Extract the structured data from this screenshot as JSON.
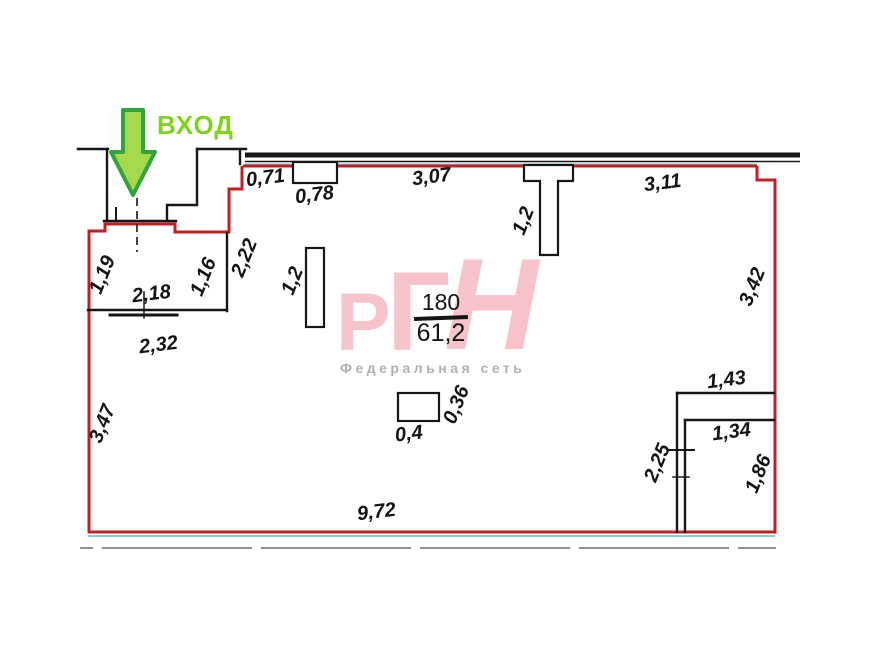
{
  "plan": {
    "entrance_label": "ВХОД",
    "room_number": "180",
    "room_area": "61,2",
    "dimensions": {
      "top_seg1": "0,71",
      "top_pier_w": "0,78",
      "top_seg2": "3,07",
      "top_seg3": "3,11",
      "column_w": "1,2",
      "right_wall": "3,42",
      "storage_top": "1,43",
      "storage_inner_top": "1,34",
      "storage_left": "2,25",
      "storage_right": "1,86",
      "bottom_wall": "9,72",
      "left_wall": "3,47",
      "vestibule_left": "1,19",
      "vestibule_right": "1,16",
      "vestibule_top_w": "2,18",
      "vestibule_bottom_w": "2,32",
      "vestibule_side": "2,22",
      "counter_len": "1,2",
      "box_w": "0,4",
      "box_h": "0,36"
    }
  },
  "watermark": {
    "logo_letters": [
      "Р",
      "Г",
      "Н"
    ],
    "subtitle": "Федеральная сеть"
  },
  "colors": {
    "outline_red": "#C41E25",
    "wall_black": "#161616",
    "glass_cyan": "#7FD2D0",
    "arrow_fill": "#A6D84B",
    "arrow_outline": "#2FA53C",
    "entrance_text_green": "#7FD31A",
    "watermark_pink": "#F6C3CB",
    "subtitle_gray": "#B0B0B0",
    "sidewalk_gray": "#8F8F8F"
  }
}
